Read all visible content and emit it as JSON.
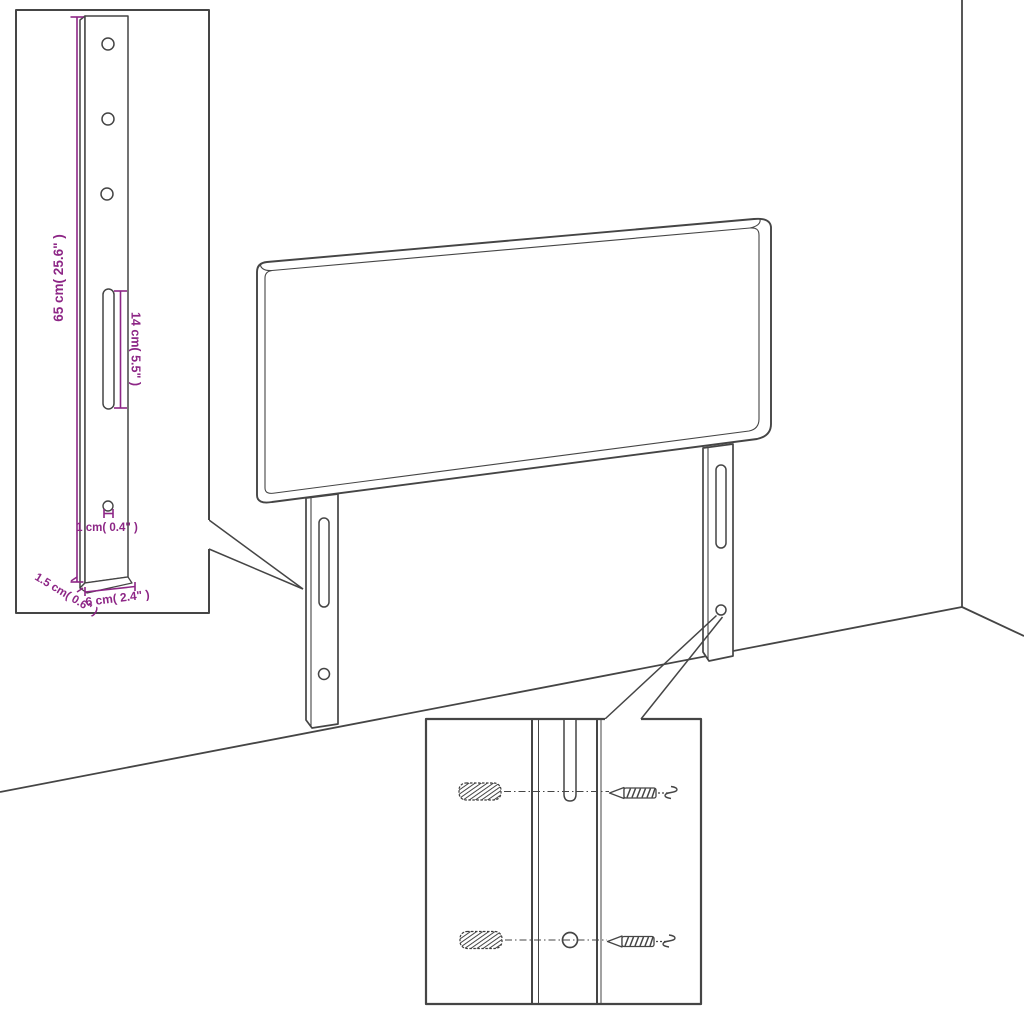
{
  "diagram": {
    "description": "Upholstered headboard with two slotted mounting legs, wall corner, and two zoom-detail callouts (leg dimensions; screw and wall-plug fixing detail)",
    "colors": {
      "background": "#ffffff",
      "line": "#454545",
      "dimension": "#8d2686"
    },
    "labels": {
      "leg_height": "65 cm( 25.6\" )",
      "slot_length": "14 cm( 5.5\" )",
      "hole_diameter": "1 cm( 0.4\" )",
      "leg_thickness": "1.5 cm( 0.6\" )",
      "leg_width": "6 cm( 2.4\" )"
    }
  }
}
